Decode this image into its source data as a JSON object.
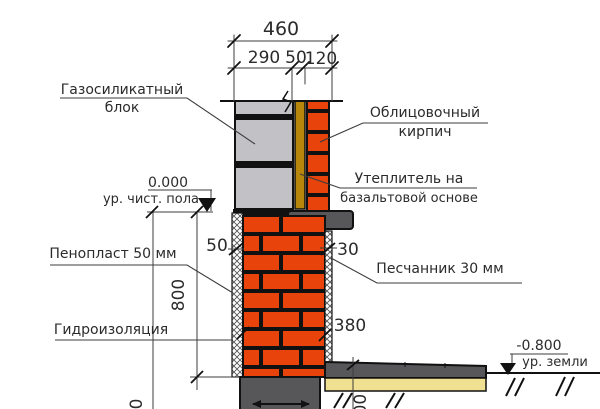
{
  "drawing_title": "Wall and plinth section detail",
  "colors": {
    "background": "#ffffff",
    "gas_silicate_gray": "#c1c1c6",
    "brick_orange": "#e8430b",
    "insulation_yellow": "#b8860b",
    "concrete_gray": "#57575a",
    "sand_yellow": "#f0e192",
    "line_black": "#111111",
    "dim_line_gray": "#3c3c3c",
    "text_color": "#2b2b2b"
  },
  "top_dimensions": {
    "total_width": "460",
    "block_width": "290",
    "insulation_width": "50",
    "facing_brick_width": "120"
  },
  "side_dimensions": {
    "foam_width": "50",
    "sandstone_width": "30",
    "plinth_height": "800",
    "plinth_width": "380",
    "slab_thickness_cut": "100",
    "left_dim_cut": "0"
  },
  "levels": {
    "floor_value": "0.000",
    "floor_label": "ур. чист. пола",
    "ground_value": "-0.800",
    "ground_label": "ур. земли"
  },
  "labels": {
    "gas_silicate_line1": "Газосиликатный",
    "gas_silicate_line2": "блок",
    "facing_brick_line1": "Облицовочный",
    "facing_brick_line2": "кирпич",
    "insulation_line1": "Утеплитель на",
    "insulation_line2": "базальтовой основе",
    "foam": "Пенопласт 50 мм",
    "sandstone": "Песчанник 30 мм",
    "waterproofing": "Гидроизоляция"
  }
}
